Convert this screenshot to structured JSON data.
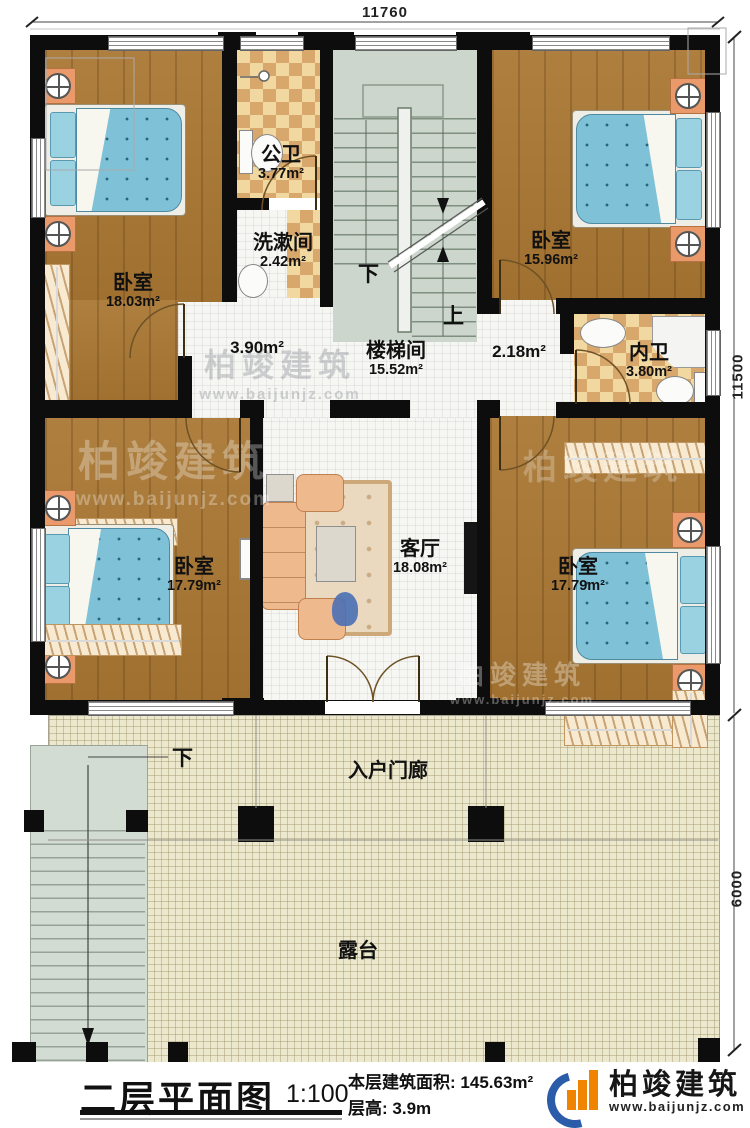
{
  "meta": {
    "title": "二层平面图",
    "scale": "1:100",
    "floor_area_label": "本层建筑面积:",
    "floor_area_value": "145.63m²",
    "floor_height_label": "层高:",
    "floor_height_value": "3.9m"
  },
  "branding": {
    "name": "柏竣建筑",
    "url": "www.baijunjz.com"
  },
  "dimensions": {
    "top": "11760",
    "right_upper": "11500",
    "right_lower": "6000"
  },
  "rooms": [
    {
      "name": "卧室",
      "area": "18.03m²"
    },
    {
      "name": "公卫",
      "area": "3.77m²"
    },
    {
      "name": "洗漱间",
      "area": "2.42m²"
    },
    {
      "name": "楼梯间",
      "area": "15.52m²"
    },
    {
      "name": "卧室",
      "area": "15.96m²"
    },
    {
      "name": "内卫",
      "area": "3.80m²"
    },
    {
      "area": "3.90m²"
    },
    {
      "area": "2.18m²"
    },
    {
      "name": "卧室",
      "area": "17.79m²"
    },
    {
      "name": "客厅",
      "area": "18.08m²"
    },
    {
      "name": "卧室",
      "area": "17.79m²"
    },
    {
      "name": "入户门廊"
    },
    {
      "name": "露台"
    }
  ],
  "stairs": {
    "up": "上",
    "down": "下",
    "terrace_down": "下"
  }
}
